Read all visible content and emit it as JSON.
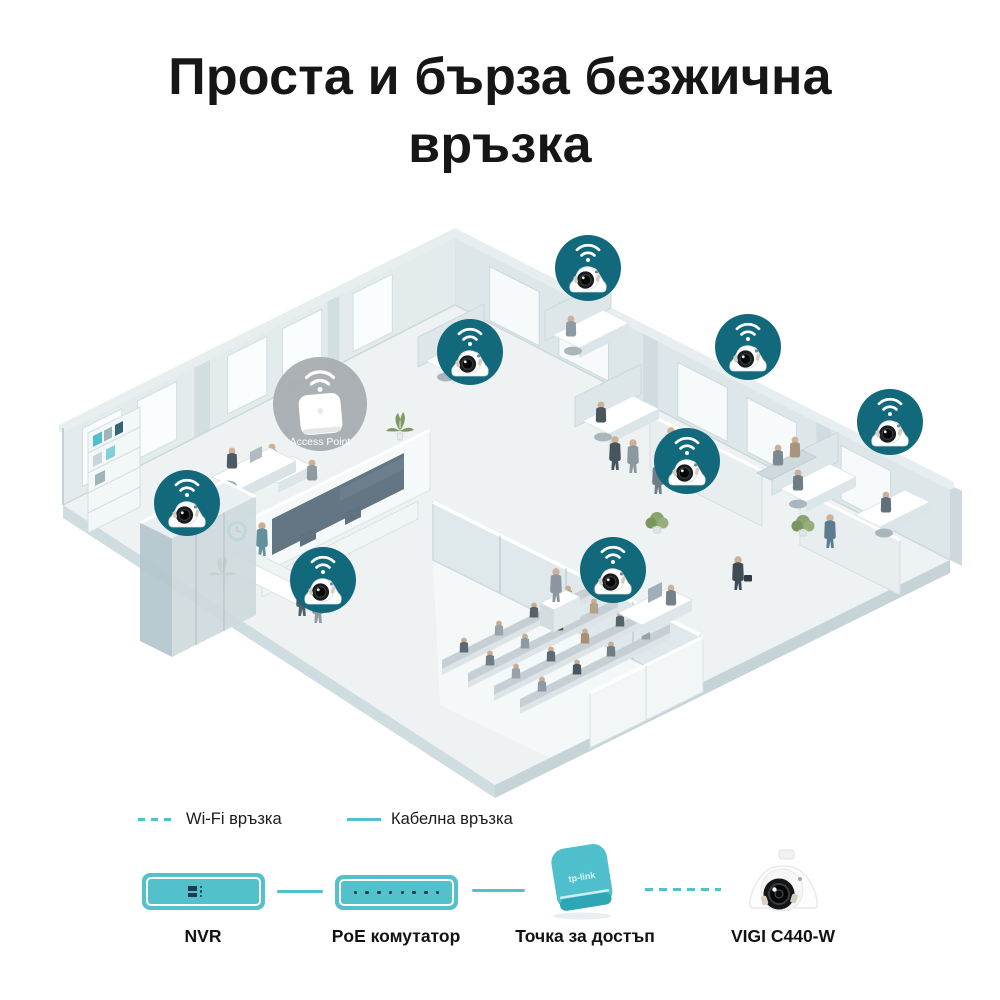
{
  "title": "Проста и бърза безжична връзка",
  "scene": {
    "access_point": {
      "label": "Access Point",
      "x": 320,
      "y": 199
    },
    "cameras": [
      {
        "id": "cam-1",
        "x": 588,
        "y": 63
      },
      {
        "id": "cam-2",
        "x": 470,
        "y": 147
      },
      {
        "id": "cam-3",
        "x": 748,
        "y": 142
      },
      {
        "id": "cam-4",
        "x": 890,
        "y": 217
      },
      {
        "id": "cam-5",
        "x": 687,
        "y": 256
      },
      {
        "id": "cam-6",
        "x": 187,
        "y": 298
      },
      {
        "id": "cam-7",
        "x": 323,
        "y": 375
      },
      {
        "id": "cam-8",
        "x": 613,
        "y": 365
      }
    ]
  },
  "legend": {
    "wifi": {
      "style": "dashed",
      "label": "Wi-Fi връзка"
    },
    "wired": {
      "style": "solid",
      "label": "Кабелна връзка"
    }
  },
  "devices": [
    {
      "id": "nvr",
      "label": "NVR",
      "icon": "nvr-icon"
    },
    {
      "id": "poe-switch",
      "label": "PoE комутатор",
      "icon": "poe-switch-icon"
    },
    {
      "id": "access-point",
      "label": "Точка за достъп",
      "icon": "access-point-icon",
      "logo": "tp-link"
    },
    {
      "id": "camera",
      "label": "VIGI C440-W",
      "icon": "turret-camera-icon"
    }
  ],
  "connections": [
    {
      "from": "nvr",
      "to": "poe-switch",
      "type": "wired"
    },
    {
      "from": "poe-switch",
      "to": "access-point",
      "type": "wired"
    },
    {
      "from": "access-point",
      "to": "camera",
      "type": "wifi"
    }
  ],
  "colors": {
    "accent_teal": "#53c1cb",
    "camera_badge_teal": "#12697c",
    "ap_circle_gray": "#a6abae",
    "port_dark": "#1d3a50",
    "title_text": "#161616"
  }
}
